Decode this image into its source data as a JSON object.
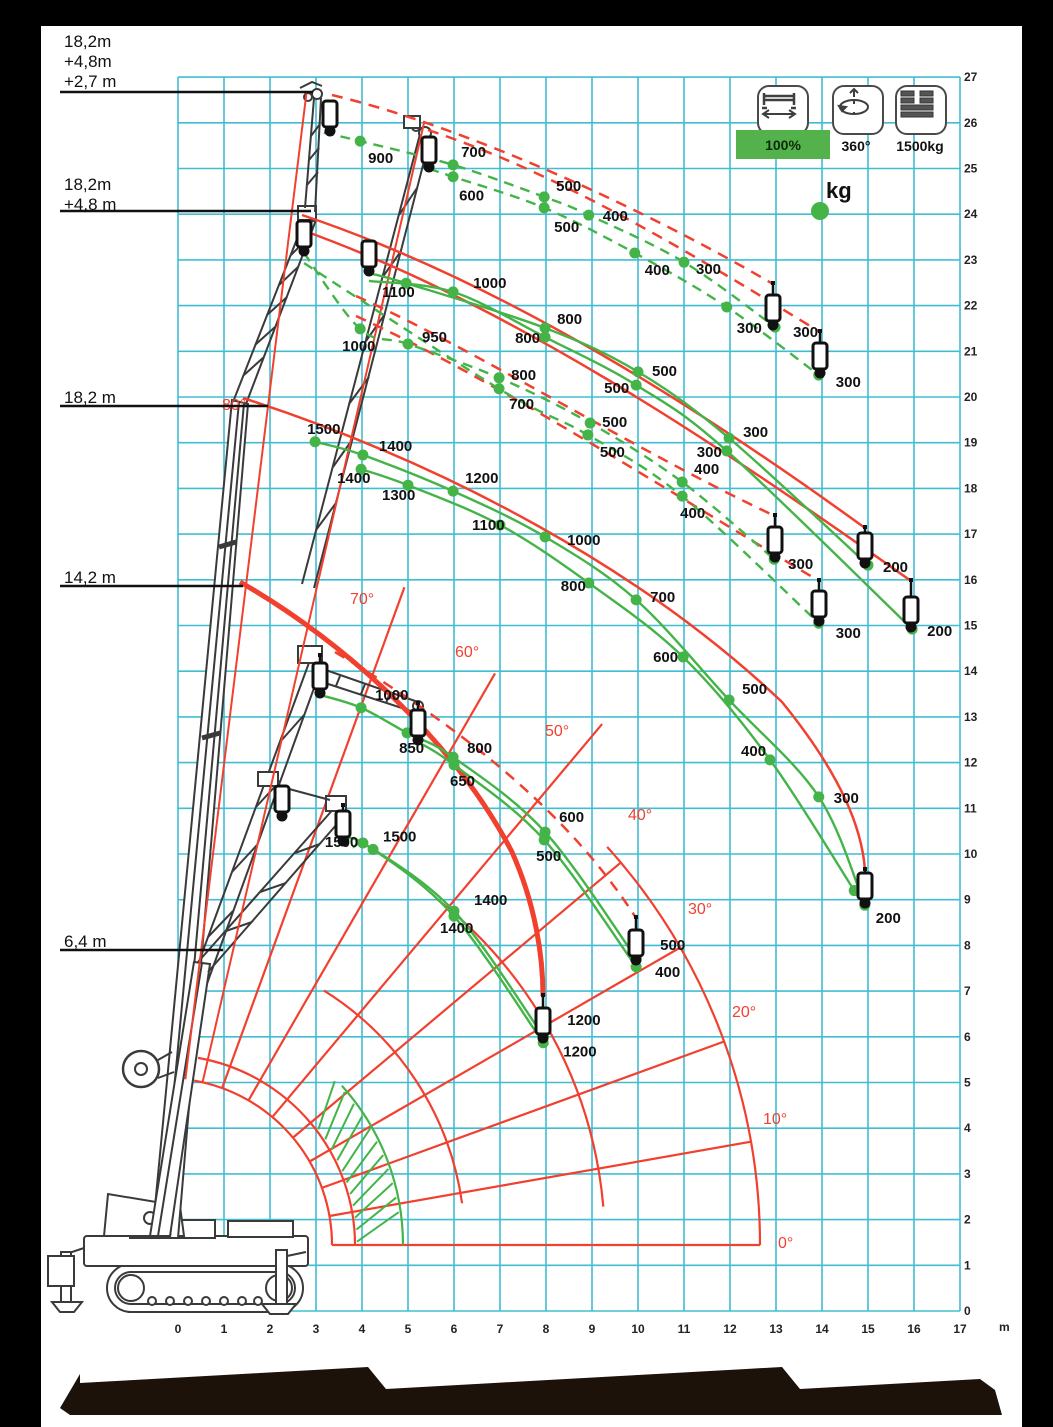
{
  "colors": {
    "grid": "#41bdd3",
    "green": "#44b449",
    "red": "#f2402f",
    "text": "#111111",
    "legend_green": "#54b24c",
    "footer_band": "#1c1209"
  },
  "legend": {
    "items": [
      {
        "icon": "outrigger-span-icon",
        "label": "100%",
        "highlighted": true
      },
      {
        "icon": "rotation-360-icon",
        "label": "360°",
        "highlighted": false
      },
      {
        "icon": "counterweight-icon",
        "label": "1500kg",
        "highlighted": false
      }
    ],
    "unit_marker": "kg",
    "unit_marker_px": [
      820,
      211
    ]
  },
  "boom_configs": [
    {
      "lines": [
        "18,2m",
        "+4,8m",
        "+2,7 m"
      ],
      "label_top": 32,
      "leader_y": 92,
      "leader_x2": 313
    },
    {
      "lines": [
        "18,2m",
        "+4,8 m"
      ],
      "label_top": 175,
      "leader_y": 211,
      "leader_x2": 311
    },
    {
      "lines": [
        "18,2 m"
      ],
      "label_top": 388,
      "leader_y": 406,
      "leader_x2": 268
    },
    {
      "lines": [
        "14,2 m"
      ],
      "label_top": 568,
      "leader_y": 586,
      "leader_x2": 243
    },
    {
      "lines": [
        "6,4 m"
      ],
      "label_top": 932,
      "leader_y": 950,
      "leader_x2": 223
    }
  ],
  "axes": {
    "x_ticks": [
      "0",
      "1",
      "2",
      "3",
      "4",
      "5",
      "6",
      "7",
      "8",
      "9",
      "10",
      "11",
      "12",
      "13",
      "14",
      "15",
      "16",
      "17"
    ],
    "x_unit": "m",
    "y_ticks": [
      "0",
      "1",
      "2",
      "3",
      "4",
      "5",
      "6",
      "7",
      "8",
      "9",
      "10",
      "11",
      "12",
      "13",
      "14",
      "15",
      "16",
      "17",
      "18",
      "19",
      "20",
      "21",
      "22",
      "23",
      "24",
      "25",
      "26",
      "27"
    ]
  },
  "angles": [
    {
      "label": "0°",
      "x": 778,
      "y": 1236
    },
    {
      "label": "10°",
      "x": 763,
      "y": 1112
    },
    {
      "label": "20°",
      "x": 732,
      "y": 1005
    },
    {
      "label": "30°",
      "x": 688,
      "y": 902
    },
    {
      "label": "40°",
      "x": 628,
      "y": 808
    },
    {
      "label": "50°",
      "x": 545,
      "y": 724
    },
    {
      "label": "60°",
      "x": 455,
      "y": 645
    },
    {
      "label": "70°",
      "x": 350,
      "y": 592
    },
    {
      "label": "80°",
      "x": 222,
      "y": 398
    }
  ],
  "chart_data": {
    "type": "line",
    "x_axis": {
      "label": "outreach",
      "unit": "m",
      "range": [
        0,
        17
      ]
    },
    "y_axis": {
      "label": "height",
      "unit": "m",
      "range": [
        0,
        27
      ]
    },
    "series": [
      {
        "name": "jib-2.7m-upper",
        "style": "dashed",
        "points": [
          [
            3.17,
            25.78,
            null,
            0,
            0
          ],
          [
            3.96,
            25.6,
            "900",
            8,
            22
          ],
          [
            5.98,
            25.08,
            "700",
            8,
            -8
          ],
          [
            7.96,
            24.38,
            "500",
            12,
            -6
          ],
          [
            8.93,
            23.98,
            "400",
            14,
            6
          ],
          [
            11.0,
            22.95,
            "300",
            12,
            12
          ],
          [
            12.98,
            21.53,
            "300",
            18,
            10
          ]
        ]
      },
      {
        "name": "jib-2.7m-lower",
        "style": "dashed",
        "points": [
          [
            5.46,
            24.99,
            null,
            0,
            0
          ],
          [
            5.98,
            24.82,
            "600",
            6,
            24
          ],
          [
            7.96,
            24.14,
            "500",
            10,
            24
          ],
          [
            9.93,
            23.15,
            "400",
            10,
            22
          ],
          [
            11.93,
            21.97,
            "300",
            10,
            26
          ],
          [
            13.93,
            20.48,
            "300",
            17,
            12
          ]
        ]
      },
      {
        "name": "jib-4.8m-upper",
        "style": "dashed",
        "points": [
          [
            2.74,
            23.15,
            null,
            0,
            0
          ],
          [
            3.96,
            21.49,
            "1000",
            -18,
            22
          ],
          [
            5.0,
            21.16,
            "950",
            14,
            -2
          ],
          [
            6.98,
            20.42,
            "800",
            12,
            2
          ],
          [
            8.96,
            19.43,
            "500",
            12,
            4
          ],
          [
            10.96,
            18.14,
            "400",
            12,
            -8
          ],
          [
            12.96,
            16.45,
            "300",
            14,
            10
          ]
        ]
      },
      {
        "name": "jib-4.8m-lower",
        "style": "dashed",
        "points": [
          [
            2.74,
            22.93,
            null,
            0,
            0
          ],
          [
            6.98,
            20.18,
            "700",
            10,
            20
          ],
          [
            8.91,
            19.17,
            "500",
            12,
            22
          ],
          [
            10.96,
            17.83,
            "400",
            -2,
            22
          ],
          [
            13.93,
            15.05,
            "300",
            17,
            15
          ]
        ]
      },
      {
        "name": "boom-23m-upper",
        "style": "solid",
        "points": [
          [
            4.15,
            22.71,
            null,
            0,
            0
          ],
          [
            4.96,
            22.49,
            "1100",
            -24,
            14
          ],
          [
            7.98,
            21.51,
            "800",
            12,
            -4
          ],
          [
            10.0,
            20.55,
            "500",
            14,
            4
          ],
          [
            11.98,
            19.1,
            "300",
            14,
            -1
          ],
          [
            15.0,
            16.32,
            "200",
            15,
            7
          ]
        ]
      },
      {
        "name": "boom-23m-lower",
        "style": "solid",
        "points": [
          [
            4.15,
            22.54,
            null,
            0,
            0
          ],
          [
            5.98,
            22.3,
            "1000",
            20,
            -4
          ],
          [
            7.98,
            21.31,
            "800",
            -30,
            6
          ],
          [
            9.96,
            20.26,
            "500",
            -32,
            8
          ],
          [
            11.93,
            18.82,
            "300",
            -30,
            6
          ],
          [
            15.96,
            14.92,
            "200",
            15,
            7
          ]
        ]
      },
      {
        "name": "boom-18.2m-upper",
        "style": "solid",
        "points": [
          [
            2.98,
            19.02,
            "1500",
            -8,
            -8
          ],
          [
            4.02,
            18.73,
            "1400",
            16,
            -4
          ],
          [
            5.98,
            17.94,
            "1200",
            12,
            -8
          ],
          [
            7.98,
            16.94,
            "1000",
            22,
            8
          ],
          [
            9.96,
            15.56,
            "700",
            14,
            2
          ],
          [
            11.98,
            13.37,
            "500",
            13,
            -6
          ],
          [
            13.93,
            11.25,
            "300",
            15,
            6
          ],
          [
            14.93,
            8.88,
            "200",
            11,
            18
          ]
        ]
      },
      {
        "name": "boom-18.2m-lower",
        "style": "solid",
        "points": [
          [
            3.98,
            18.42,
            "1400",
            -24,
            14
          ],
          [
            5.0,
            18.07,
            "1300",
            -26,
            15
          ],
          [
            7.0,
            17.2,
            "1100",
            -28,
            5
          ],
          [
            8.93,
            15.93,
            "800",
            -28,
            8
          ],
          [
            10.98,
            14.31,
            "600",
            -30,
            5
          ],
          [
            12.87,
            12.06,
            "400",
            -29,
            -4
          ],
          [
            14.7,
            9.2,
            null,
            0,
            0
          ]
        ]
      },
      {
        "name": "mid-boom-upper",
        "style": "solid",
        "points": [
          [
            3.09,
            13.48,
            null,
            0,
            0
          ],
          [
            3.98,
            13.2,
            "1000",
            14,
            -8
          ],
          [
            4.98,
            12.65,
            "850",
            -8,
            20
          ],
          [
            5.98,
            12.12,
            "800",
            14,
            -4
          ],
          [
            7.98,
            10.48,
            "600",
            14,
            -10
          ],
          [
            9.96,
            7.72,
            "500",
            24,
            -8
          ]
        ]
      },
      {
        "name": "mid-boom-lower",
        "style": "solid",
        "points": [
          [
            5.22,
            12.45,
            null,
            0,
            0
          ],
          [
            6.0,
            11.95,
            "650",
            -4,
            21
          ],
          [
            7.96,
            10.31,
            "500",
            -8,
            21
          ],
          [
            9.96,
            7.53,
            "400",
            19,
            10
          ]
        ]
      },
      {
        "name": "boom-14.2m-upper",
        "style": "solid",
        "points": [
          [
            3.59,
            10.24,
            null,
            0,
            0
          ],
          [
            4.02,
            10.24,
            "1500",
            -38,
            4
          ],
          [
            6.0,
            8.75,
            "1400",
            20,
            -6
          ],
          [
            7.94,
            6.02,
            "1200",
            24,
            -11
          ]
        ]
      },
      {
        "name": "boom-14.2m-lower",
        "style": "solid",
        "points": [
          [
            3.8,
            10.15,
            null,
            0,
            0
          ],
          [
            4.24,
            10.1,
            "1500",
            10,
            -8
          ],
          [
            6.0,
            8.64,
            "1400",
            -14,
            17
          ],
          [
            7.94,
            5.87,
            "1200",
            20,
            14
          ]
        ]
      }
    ],
    "hooks": [
      [
        330,
        112,
        133
      ],
      [
        429,
        148,
        169
      ],
      [
        304,
        230,
        253
      ],
      [
        369,
        250,
        273
      ],
      [
        773,
        284,
        327
      ],
      [
        820,
        332,
        375
      ],
      [
        775,
        516,
        559
      ],
      [
        865,
        528,
        565
      ],
      [
        819,
        581,
        623
      ],
      [
        911,
        581,
        629
      ],
      [
        865,
        870,
        905
      ],
      [
        418,
        704,
        742
      ],
      [
        343,
        806,
        843
      ],
      [
        543,
        996,
        1040
      ],
      [
        636,
        918,
        962
      ],
      [
        320,
        656,
        695
      ],
      [
        282,
        790,
        818
      ]
    ],
    "red_envelopes": [
      {
        "d": "M332,95 C470,128 650,212 773,284",
        "style": "dashed",
        "w": 2.5
      },
      {
        "d": "M428,130 C565,175 705,262 820,332",
        "style": "dashed",
        "w": 2.5
      },
      {
        "d": "M356,296 C480,352 638,452 775,516",
        "style": "dashed",
        "w": 2.5
      },
      {
        "d": "M356,316 C490,377 650,480 819,581",
        "style": "dashed",
        "w": 2.5
      },
      {
        "d": "M302,215 C505,283 705,412 865,528",
        "style": "solid",
        "w": 2.5
      },
      {
        "d": "M299,229 C505,302 715,442 911,581",
        "style": "solid",
        "w": 2.5
      },
      {
        "d": "M243,398 C450,465 645,572 782,702 C843,777 862,830 865,870",
        "style": "solid",
        "w": 2.5
      },
      {
        "d": "M240,582 C345,642 455,742 512,852 C536,906 543,958 543,996",
        "style": "solid",
        "w": 5
      },
      {
        "d": "M335,652 C442,716 562,802 636,918",
        "style": "dashed",
        "w": 2.5
      }
    ],
    "fan": {
      "pivot": [
        165,
        1245
      ],
      "arcs_red": [
        [
          167,
          0,
          80
        ],
        [
          190,
          0,
          80
        ],
        [
          300,
          8,
          58
        ],
        [
          440,
          5,
          52
        ],
        [
          595,
          0,
          42
        ]
      ],
      "arc_green": [
        238,
        0,
        42
      ],
      "hatch": {
        "r1": 192,
        "r2": 236,
        "a1": 1,
        "a2": 38
      },
      "radials": [
        [
          0,
          167,
          595
        ],
        [
          10,
          167,
          595
        ],
        [
          20,
          167,
          595
        ],
        [
          30,
          167,
          595
        ],
        [
          40,
          167,
          595
        ],
        [
          50,
          167,
          680
        ],
        [
          60,
          167,
          660
        ],
        [
          70,
          167,
          700
        ]
      ],
      "long_radials": [
        [
          83,
          167,
          1160
        ],
        [
          77,
          167,
          1152
        ]
      ]
    }
  }
}
